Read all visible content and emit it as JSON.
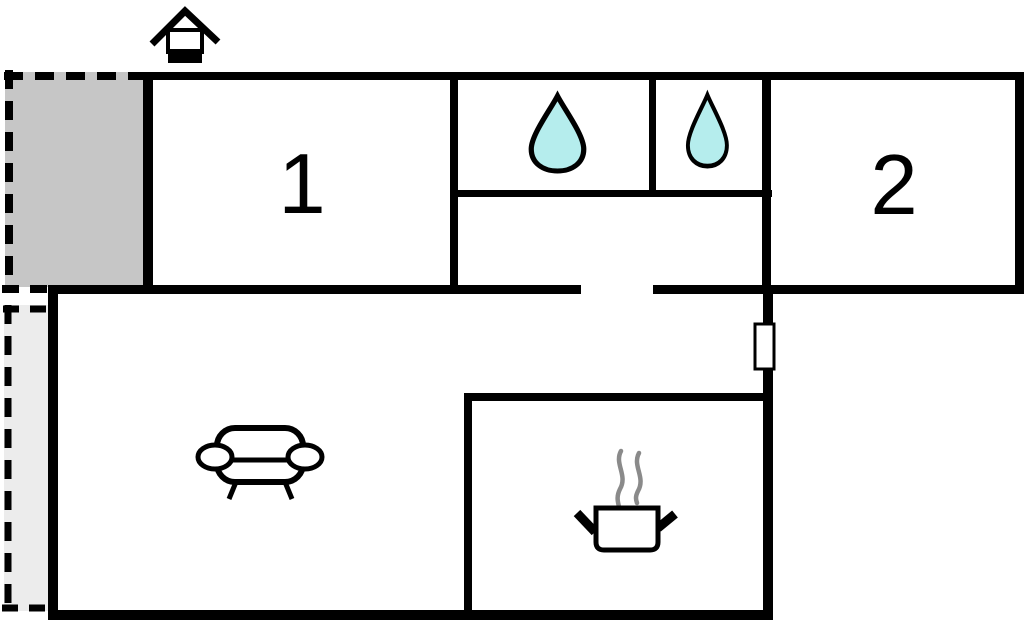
{
  "floor_plan": {
    "kind": "apartment-floor-plan",
    "rooms": [
      {
        "label": "1"
      },
      {
        "label": "2"
      }
    ],
    "icons": {
      "entrance": "entrance-icon",
      "bathroom_left": "water-drop-icon",
      "bathroom_right": "water-drop-icon",
      "living_room": "sofa-icon",
      "kitchen": "cooking-pot-icon"
    },
    "colors": {
      "wall": "#000000",
      "background": "#ffffff",
      "water_drop_fill": "#b5eded",
      "terrace_fill": "#c6c6c6",
      "patio_fill": "#ececec",
      "steam": "#8a8a8a"
    }
  }
}
